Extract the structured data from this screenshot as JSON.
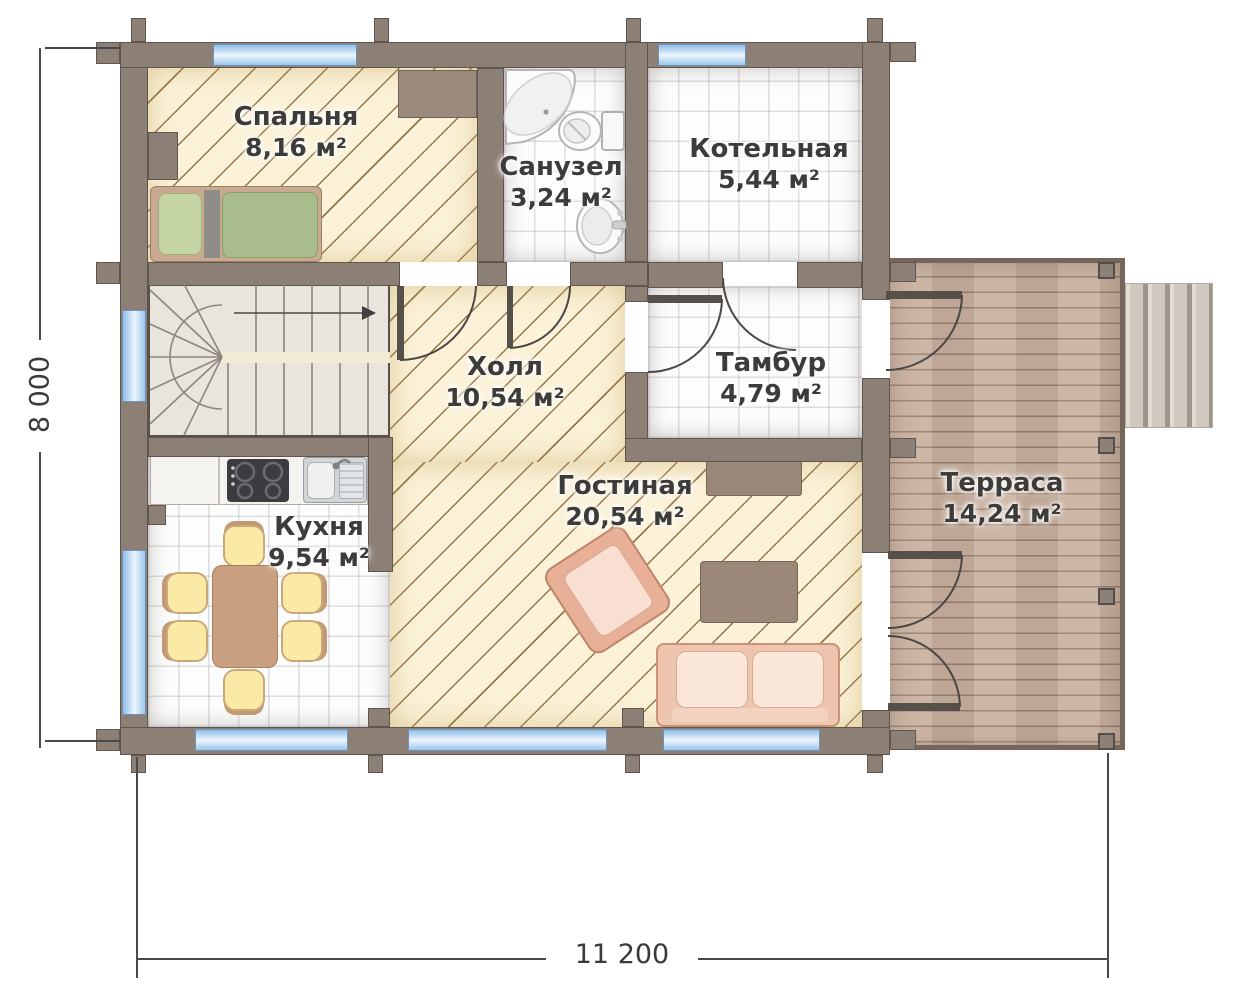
{
  "rooms": [
    {
      "id": "bedroom",
      "name": "Спальня",
      "area": "8,16 м²"
    },
    {
      "id": "bathroom",
      "name": "Санузел",
      "area": "3,24 м²"
    },
    {
      "id": "boiler",
      "name": "Котельная",
      "area": "5,44 м²"
    },
    {
      "id": "hall",
      "name": "Холл",
      "area": "10,54 м²"
    },
    {
      "id": "vestibule",
      "name": "Тамбур",
      "area": "4,79 м²"
    },
    {
      "id": "kitchen",
      "name": "Кухня",
      "area": "9,54 м²"
    },
    {
      "id": "living",
      "name": "Гостиная",
      "area": "20,54 м²"
    },
    {
      "id": "terrace",
      "name": "Терраса",
      "area": "14,24 м²"
    }
  ],
  "dimensions": {
    "vertical": "8 000",
    "horizontal": "11 200"
  },
  "colors": {
    "wall": "#8c7f76",
    "hatch_floor": "#fbf2d8",
    "tile_floor": "#fdfdfd",
    "wood_deck": "#c7ae9d",
    "window": "#aed0ee",
    "furniture_brown": "#9a8777",
    "mattress_green": "#a9bc8c",
    "sofa_pink": "#eec5ae"
  }
}
